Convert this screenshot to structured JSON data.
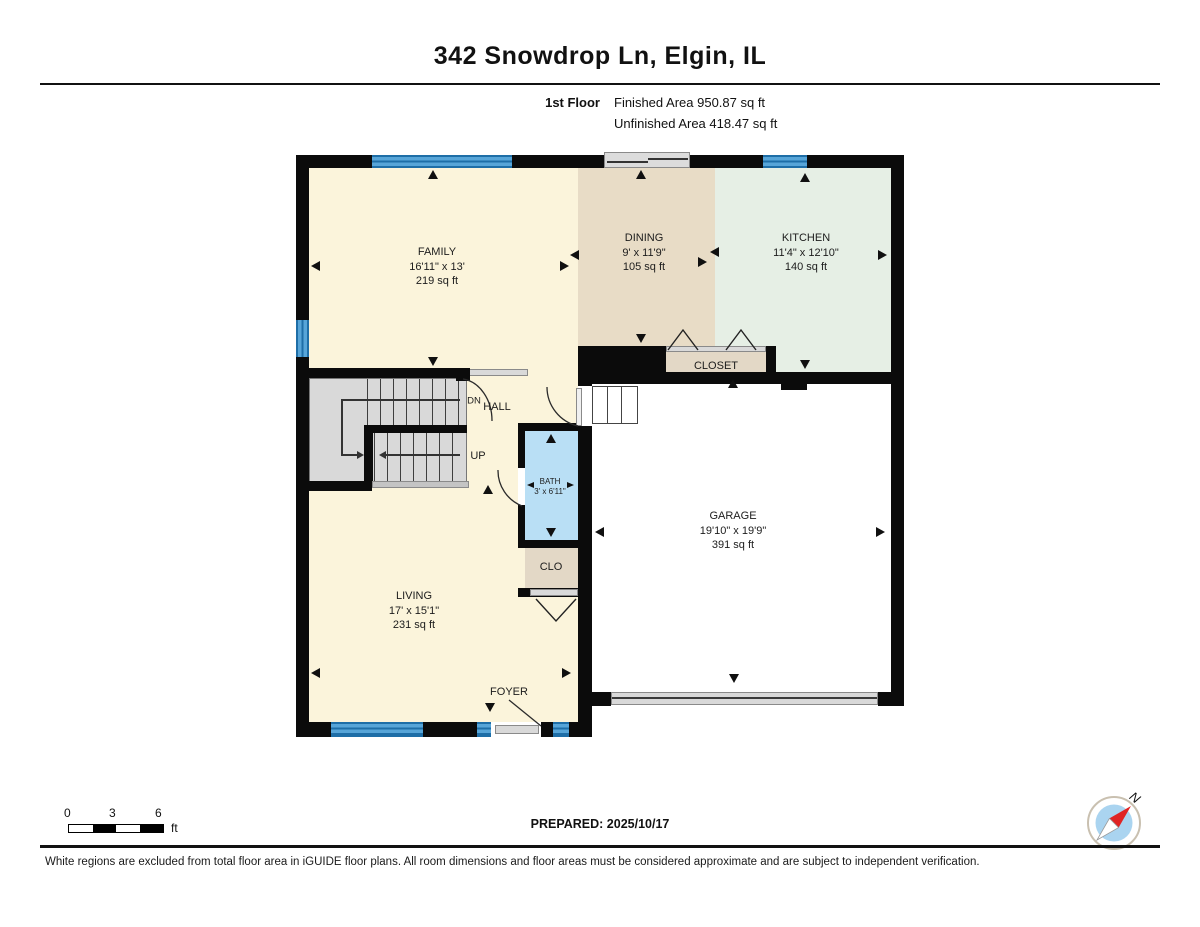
{
  "header": {
    "title": "342 Snowdrop Ln, Elgin, IL",
    "floor_label": "1st Floor",
    "finished_area": "Finished Area 950.87 sq ft",
    "unfinished_area": "Unfinished Area 418.47 sq ft"
  },
  "floor_plan": {
    "rooms": [
      {
        "name": "FAMILY",
        "dimensions": "16'11\" x 13'",
        "area": "219 sq ft"
      },
      {
        "name": "DINING",
        "dimensions": "9' x 11'9\"",
        "area": "105 sq ft"
      },
      {
        "name": "KITCHEN",
        "dimensions": "11'4\" x 12'10\"",
        "area": "140 sq ft"
      },
      {
        "name": "GARAGE",
        "dimensions": "19'10\" x 19'9\"",
        "area": "391 sq ft"
      },
      {
        "name": "LIVING",
        "dimensions": "17' x 15'1\"",
        "area": "231 sq ft"
      },
      {
        "name": "BATH",
        "dimensions": "3' x 6'11\""
      },
      {
        "name": "CLOSET"
      },
      {
        "name": "CLO"
      },
      {
        "name": "HALL"
      },
      {
        "name": "FOYER"
      }
    ],
    "stairs": {
      "down": "DN",
      "up": "UP"
    }
  },
  "footer": {
    "scale": {
      "ticks": [
        "0",
        "3",
        "6"
      ],
      "unit": "ft"
    },
    "prepared": "PREPARED: 2025/10/17",
    "compass": {
      "north_label": "N"
    },
    "disclaimer": "White regions are excluded from total floor area in iGUIDE floor plans. All room dimensions and floor areas must be considered approximate and are subject to independent verification."
  },
  "colors": {
    "finished_area_cream": "#FBF4DB",
    "dining_tan": "#E8DCC6",
    "kitchen_green": "#E6EFE5",
    "bath_blue": "#B9DFF5",
    "closet_tan": "#E3D8C6",
    "stairs_gray": "#D9D9D9",
    "window_blue": "#57A5D8",
    "wall_black": "#0B0B0B",
    "garage_white": "#FFFFFF",
    "compass_blue": "#AAD4F0",
    "compass_needle_red": "#E02424"
  }
}
